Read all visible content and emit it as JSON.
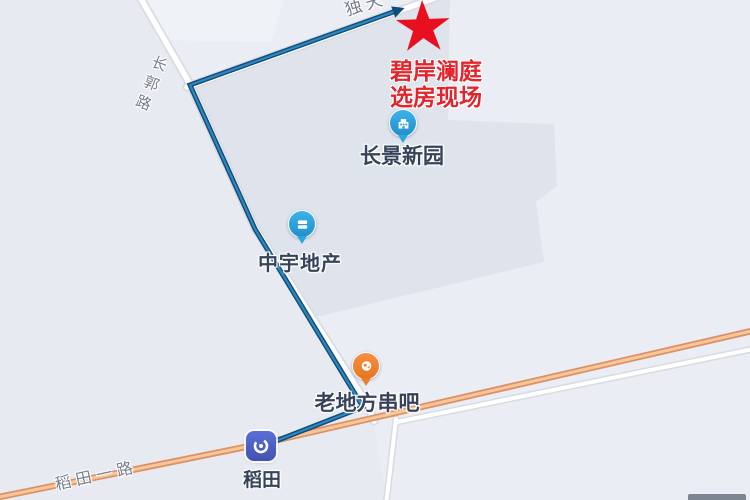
{
  "annotation": {
    "line1": "碧岸澜庭",
    "line2": "选房现场",
    "color": "#e2242c"
  },
  "pois": [
    {
      "name": "长景新园",
      "category": "residential-compound",
      "pin_color": "#2aa7e0"
    },
    {
      "name": "中宇地产",
      "category": "real-estate-company",
      "pin_color": "#2aa7e0"
    },
    {
      "name": "老地方串吧",
      "category": "restaurant",
      "pin_color": "#ef8132"
    },
    {
      "name": "稻田",
      "category": "metro-station",
      "icon_color": "#4a5cc0"
    }
  ],
  "road_labels": [
    {
      "text": "独天"
    },
    {
      "text": "长郭路"
    },
    {
      "text": "稻田一路"
    }
  ],
  "route": {
    "points": [
      [
        263,
        446
      ],
      [
        363,
        407
      ],
      [
        255,
        229
      ],
      [
        190,
        85
      ],
      [
        396,
        11
      ]
    ],
    "color_outer": "#0f4c78",
    "color_inner": "#2f86bf"
  },
  "map_colors": {
    "background": "#ebedf4",
    "background_left": "#e7eaf1",
    "parcel": "#dfe4ec",
    "parcel_light": "#eff2f7",
    "road_fill": "#ffffff",
    "road_casing": "#d8dbe2",
    "arterial_casing": "#dc9165",
    "arterial_fill": "#f7c79b",
    "star": "#e8101f"
  }
}
